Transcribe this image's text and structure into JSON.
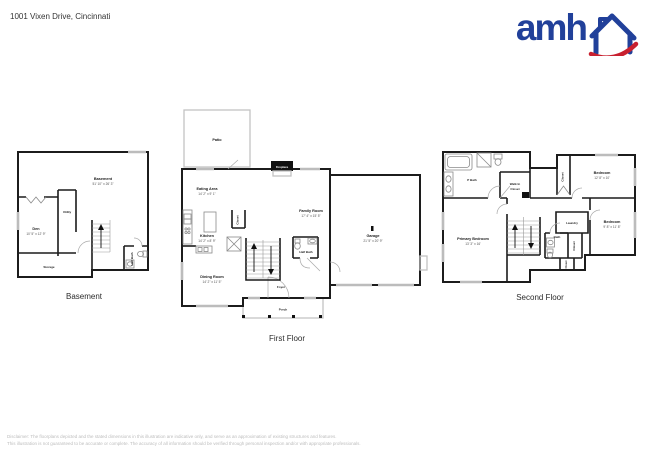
{
  "header": {
    "address": "1001 Vixen Drive, Cincinnati"
  },
  "logo": {
    "text": "amh",
    "blue": "#21409a",
    "red": "#c8202f"
  },
  "floors": {
    "basement": {
      "label": "Basement",
      "rooms": {
        "basement": {
          "name": "Basement",
          "dims": "51' 10\" x 26' 3\""
        },
        "den": {
          "name": "Den",
          "dims": "10' 5\" x 12' 9\""
        },
        "utility": {
          "name": "Utility"
        },
        "storage": {
          "name": "Storage"
        },
        "half_bath": {
          "name": "Half Bath"
        }
      }
    },
    "first": {
      "label": "First Floor",
      "rooms": {
        "patio": {
          "name": "Patio"
        },
        "fireplace": {
          "name": "Fireplace"
        },
        "eating_area": {
          "name": "Eating Area",
          "dims": "14' 2\" x 9' 1\""
        },
        "family_room": {
          "name": "Family Room",
          "dims": "17' 4\" x 15' 5\""
        },
        "kitchen": {
          "name": "Kitchen",
          "dims": "14' 2\" x 8' 9\""
        },
        "closet": {
          "name": "Closet"
        },
        "dining_room": {
          "name": "Dining Room",
          "dims": "14' 2\" x 11' 5\""
        },
        "half_bath": {
          "name": "Half Bath"
        },
        "foyer": {
          "name": "Foyer"
        },
        "porch": {
          "name": "Porch"
        },
        "garage": {
          "name": "Garage",
          "dims": "21' 5\" x 20' 9\""
        }
      }
    },
    "second": {
      "label": "Second Floor",
      "rooms": {
        "p_bath": {
          "name": "P Bath"
        },
        "walk_in_closet": {
          "line1": "Walk In",
          "line2": "Closet"
        },
        "primary_bedroom": {
          "name": "Primary Bedroom",
          "dims": "13' 3\" x 16'"
        },
        "bedroom_top": {
          "name": "Bedroom",
          "dims": "12' 8\" x 10'"
        },
        "closet_top": {
          "name": "Closet"
        },
        "laundry": {
          "name": "Laundry"
        },
        "bath": {
          "name": "Bath"
        },
        "closet_mid": {
          "name": "Closet"
        },
        "closet_bottom": {
          "name": "Closet"
        },
        "bedroom_bottom": {
          "name": "Bedroom",
          "dims": "9' 8\" x 11' 8\""
        }
      }
    }
  },
  "footer": {
    "disclaimer_line1": "Disclaimer: The floorplans depicted and the stated dimensions in this illustration are indicative only, and serve as an approximation of existing structures and features.",
    "disclaimer_line2": "This illustration is not guaranteed to be accurate or complete. The accuracy of all information should be verified through personal inspection and/or with appropriate professionals."
  }
}
